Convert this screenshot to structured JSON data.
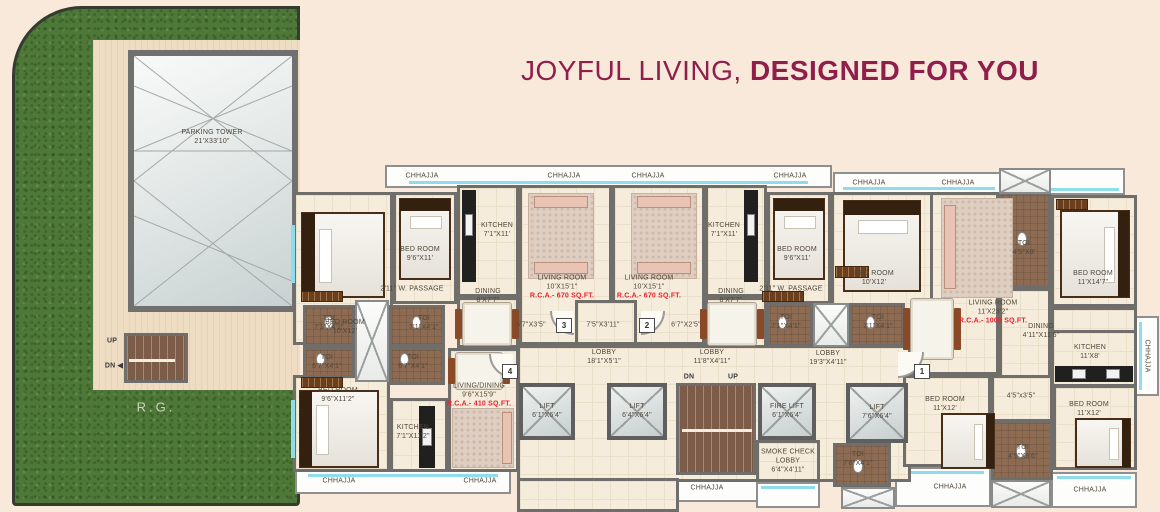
{
  "title": {
    "light": "JOYFUL LIVING,",
    "bold": "DESIGNED FOR YOU"
  },
  "colors": {
    "title_maroon": "#8f1e4b",
    "rca_red": "#e8212e",
    "grass_green": "#4e7838",
    "window_cyan": "#8edcec"
  },
  "plan": {
    "labels": [
      {
        "t": "PARKING TOWER",
        "d": "21'X33'10\"",
        "x": 212,
        "y": 137
      },
      {
        "t": "UP",
        "x": 112,
        "y": 341,
        "k": "b"
      },
      {
        "t": "DN ◀",
        "x": 114,
        "y": 366,
        "k": "b"
      },
      {
        "t": "R.G.",
        "x": 156,
        "y": 408,
        "k": "rg"
      },
      {
        "t": "CHHAJJA",
        "x": 422,
        "y": 176
      },
      {
        "t": "CHHAJJA",
        "x": 564,
        "y": 176
      },
      {
        "t": "CHHAJJA",
        "x": 648,
        "y": 176
      },
      {
        "t": "CHHAJJA",
        "x": 790,
        "y": 176
      },
      {
        "t": "CHHAJJA",
        "x": 869,
        "y": 183
      },
      {
        "t": "CHHAJJA",
        "x": 958,
        "y": 183
      },
      {
        "t": "CHHAJJA",
        "x": 339,
        "y": 481
      },
      {
        "t": "CHHAJJA",
        "x": 480,
        "y": 481
      },
      {
        "t": "CHHAJJA",
        "x": 707,
        "y": 488
      },
      {
        "t": "CHHAJJA",
        "x": 950,
        "y": 487
      },
      {
        "t": "CHHAJJA",
        "x": 1090,
        "y": 490
      },
      {
        "t": "CHHAJJA",
        "x": 1147,
        "y": 356,
        "v": 1
      },
      {
        "t": "BED ROOM",
        "d": "10'X12'",
        "x": 345,
        "y": 327
      },
      {
        "t": "BED ROOM",
        "d": "9'6\"X11'",
        "x": 420,
        "y": 254
      },
      {
        "t": "KITCHEN",
        "d": "7'1\"X11'",
        "x": 497,
        "y": 230
      },
      {
        "t": "2'11\" W. PASSAGE",
        "x": 412,
        "y": 289
      },
      {
        "t": "DINING",
        "d": "8'X7'7\"",
        "x": 488,
        "y": 296
      },
      {
        "t": "TOI",
        "d": "7'1\"X4'1\"",
        "x": 329,
        "y": 323
      },
      {
        "t": "TOI",
        "d": "7'1\"X4'1\"",
        "x": 424,
        "y": 323
      },
      {
        "t": "LIVING ROOM",
        "d": "10'X15'1\"",
        "r": "R.C.A.- 670 SQ.FT.",
        "x": 562,
        "y": 287
      },
      {
        "t": "LIVING ROOM",
        "d": "10'X15'1\"",
        "r": "R.C.A.- 670 SQ.FT.",
        "x": 649,
        "y": 287
      },
      {
        "t": "6'7\"X3'5\"",
        "x": 531,
        "y": 325
      },
      {
        "t": "7'5\"X3'11\"",
        "x": 603,
        "y": 325
      },
      {
        "t": "6'7\"X2'5\"",
        "x": 686,
        "y": 325
      },
      {
        "t": "KITCHEN",
        "d": "7'1\"X11'",
        "x": 724,
        "y": 230
      },
      {
        "t": "DINING",
        "d": "8'X7'7\"",
        "x": 731,
        "y": 296
      },
      {
        "t": "BED ROOM",
        "d": "9'6\"X11'",
        "x": 797,
        "y": 254
      },
      {
        "t": "2'11\" W. PASSAGE",
        "x": 791,
        "y": 289
      },
      {
        "t": "TOI",
        "d": "7'1\"X4'1\"",
        "x": 786,
        "y": 322
      },
      {
        "t": "TOI",
        "d": "7'1\"X4'1\"",
        "x": 878,
        "y": 322
      },
      {
        "t": "BED ROOM",
        "d": "10'X12'",
        "x": 874,
        "y": 278
      },
      {
        "t": "TOI",
        "d": "4'5\"X8'",
        "x": 1024,
        "y": 248
      },
      {
        "t": "BED ROOM",
        "d": "11'X14'7\"",
        "x": 1093,
        "y": 278
      },
      {
        "t": "LIVING ROOM",
        "d": "11'X23'2\"",
        "r": "R.C.A.- 1000 SQ.FT.",
        "x": 993,
        "y": 312
      },
      {
        "t": "DINING",
        "d": "4'11\"X11'6\"",
        "x": 1041,
        "y": 331
      },
      {
        "t": "KITCHEN",
        "d": "11'X8'",
        "x": 1090,
        "y": 352
      },
      {
        "t": "LOBBY",
        "d": "18'1\"X5'1\"",
        "x": 604,
        "y": 357
      },
      {
        "t": "LOBBY",
        "d": "11'8\"X4'11\"",
        "x": 712,
        "y": 357
      },
      {
        "t": "LOBBY",
        "d": "19'3\"X4'11\"",
        "x": 828,
        "y": 358
      },
      {
        "t": "DN",
        "x": 689,
        "y": 377,
        "k": "b"
      },
      {
        "t": "UP",
        "x": 733,
        "y": 377,
        "k": "b"
      },
      {
        "t": "LIFT",
        "d": "6'1\"X6'4\"",
        "x": 547,
        "y": 411
      },
      {
        "t": "LIFT",
        "d": "6'4\"X6'4\"",
        "x": 637,
        "y": 411
      },
      {
        "t": "FIRE LIFT",
        "d": "6'1\"X6'4\"",
        "x": 787,
        "y": 411
      },
      {
        "t": "LIFT",
        "d": "7'6\"X6'4\"",
        "x": 877,
        "y": 412
      },
      {
        "t": "SMOKE CHECK",
        "d": "LOBBY",
        "d2": "6'4\"X4'11\"",
        "x": 788,
        "y": 461
      },
      {
        "t": "TOI",
        "d": "7'6\"X4'1\"",
        "x": 858,
        "y": 459
      },
      {
        "t": "TOI",
        "d": "6'7\"X4'1\"",
        "x": 327,
        "y": 362
      },
      {
        "t": "TOI",
        "d": "6'7\"X4'1\"",
        "x": 413,
        "y": 362
      },
      {
        "t": "BED ROOM",
        "d": "9'6\"X11'2\"",
        "x": 338,
        "y": 395
      },
      {
        "t": "KITCHEN",
        "d": "7'1\"X11'2\"",
        "x": 413,
        "y": 432
      },
      {
        "t": "LIVING/DINING",
        "d": "9'6\"X15'9\"",
        "r": "R.C.A.- 410 SQ.FT.",
        "x": 479,
        "y": 395
      },
      {
        "t": "BED ROOM",
        "d": "11'X12'",
        "x": 945,
        "y": 404
      },
      {
        "t": "4'5\"x3'5\"",
        "x": 1021,
        "y": 396
      },
      {
        "t": "TOI",
        "d": "4'5\"X8'6\"",
        "x": 1023,
        "y": 452
      },
      {
        "t": "BED ROOM",
        "d": "11'X12'",
        "x": 1089,
        "y": 409
      }
    ],
    "unit_markers": [
      {
        "n": "3",
        "x": 563,
        "y": 325
      },
      {
        "n": "2",
        "x": 646,
        "y": 325
      },
      {
        "n": "1",
        "x": 921,
        "y": 371
      },
      {
        "n": "4",
        "x": 509,
        "y": 371
      }
    ]
  }
}
